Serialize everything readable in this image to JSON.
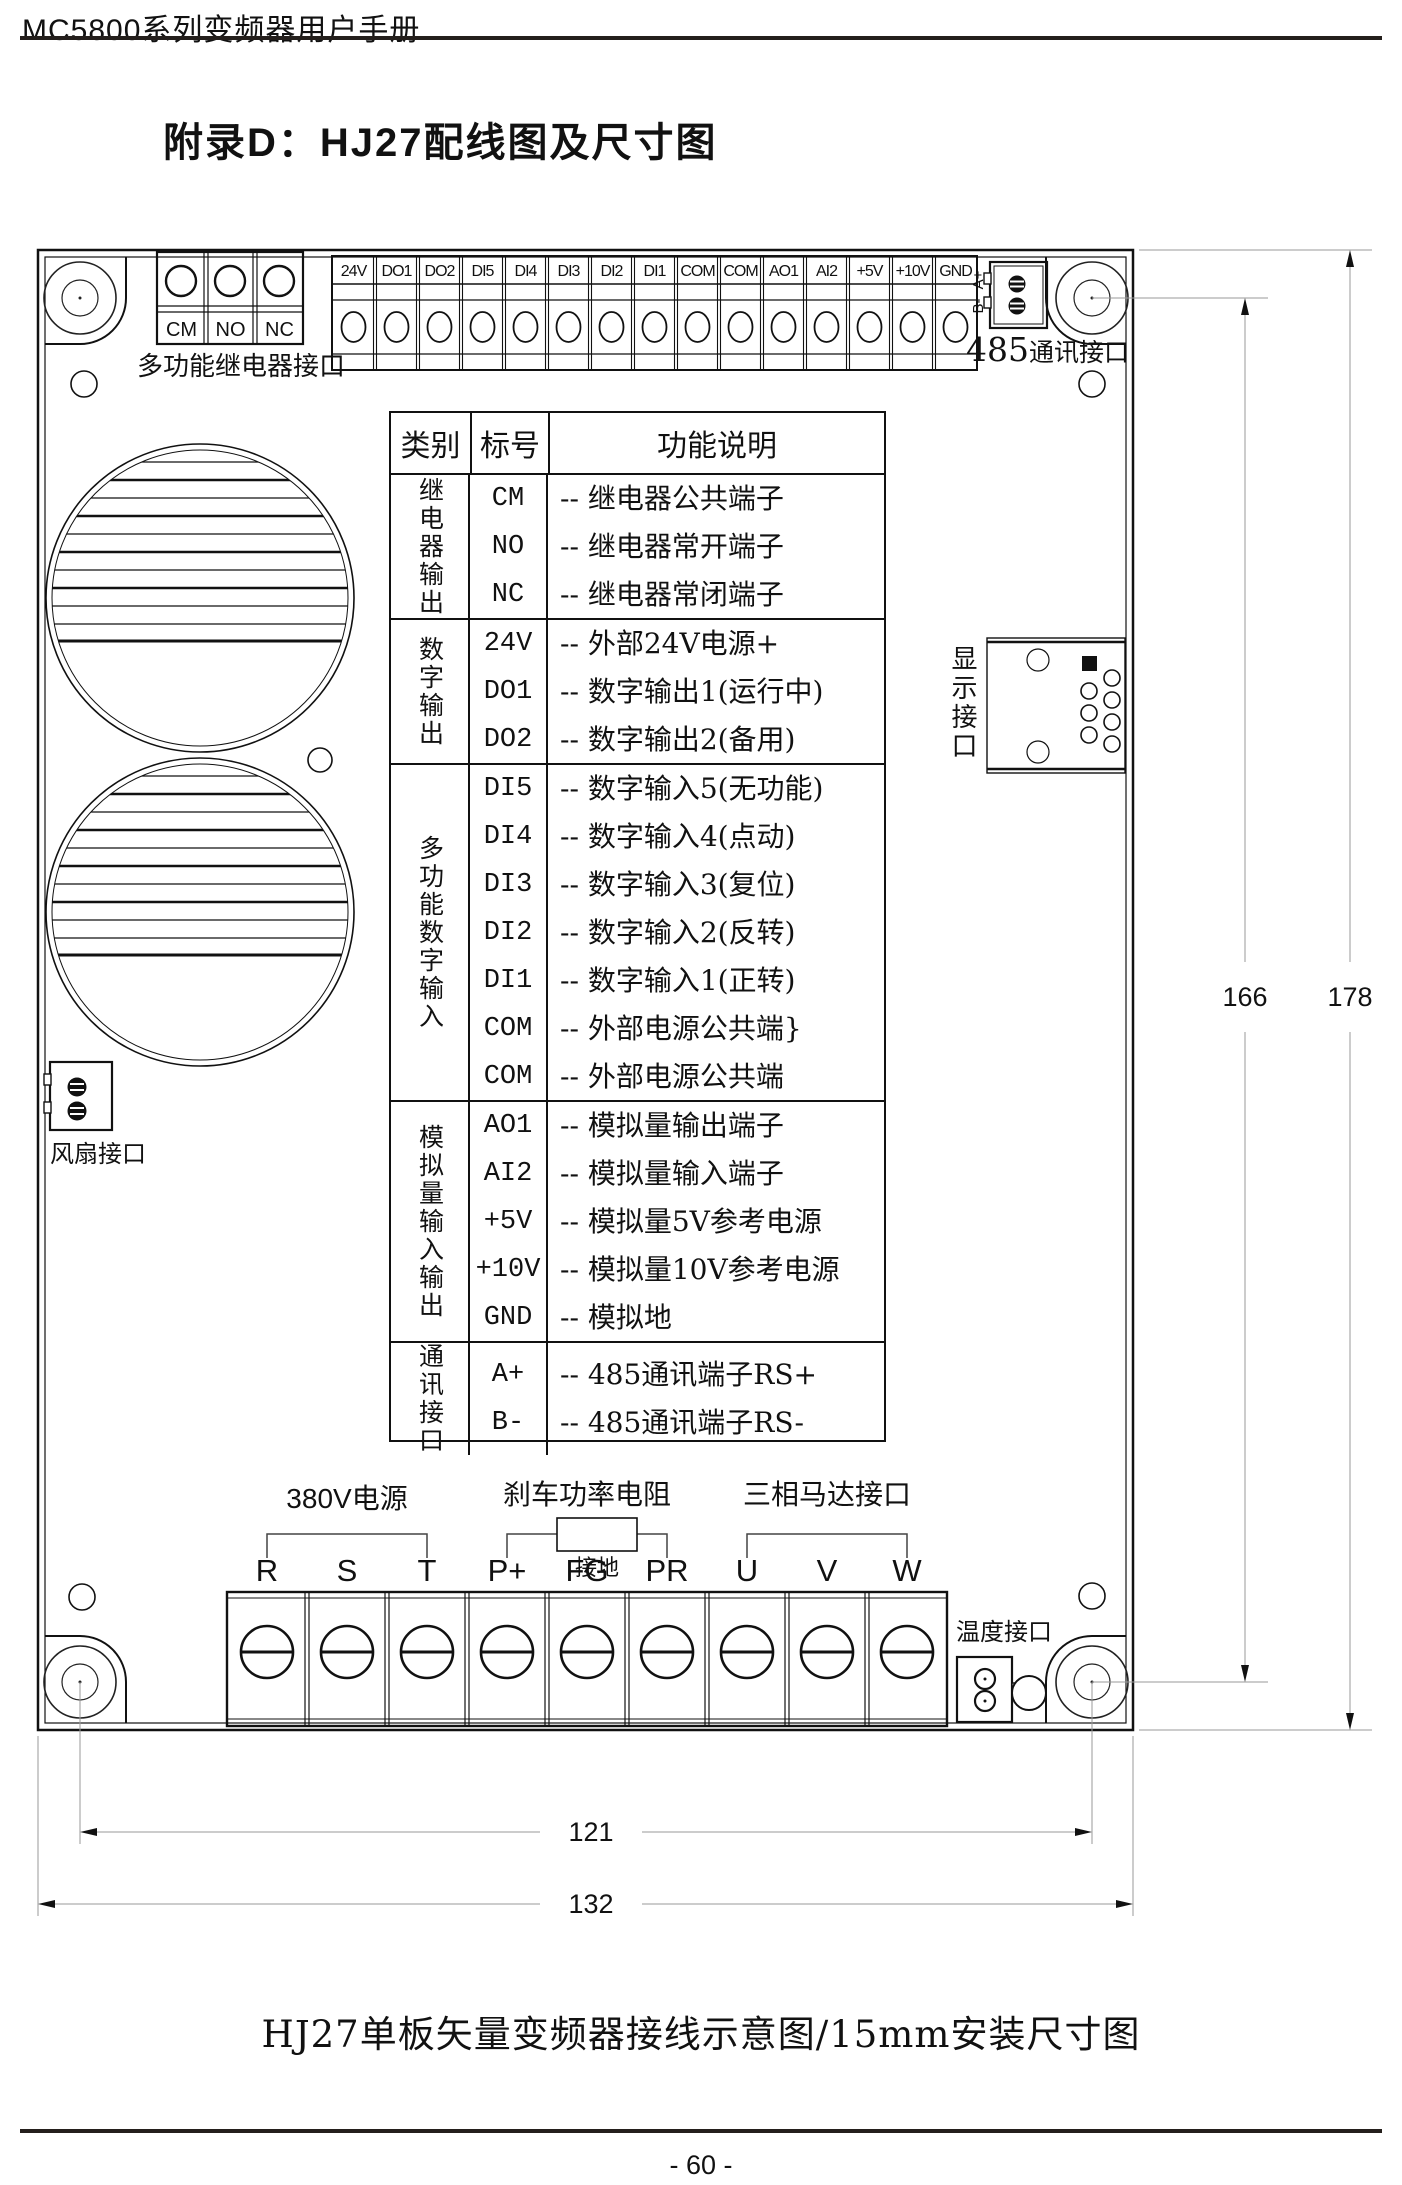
{
  "header": {
    "manual_title": "MC5800系列变频器用户手册"
  },
  "page_title": "附录D：HJ27配线图及尺寸图",
  "board": {
    "relay_port": {
      "terminals": [
        "CM",
        "NO",
        "NC"
      ],
      "caption": "多功能继电器接口"
    },
    "top_terminals": [
      "24V",
      "DO1",
      "DO2",
      "DI5",
      "DI4",
      "DI3",
      "DI2",
      "DI1",
      "COM",
      "COM",
      "AO1",
      "AI2",
      "+5V",
      "+10V",
      "GND"
    ],
    "rs485_port": {
      "pin_a": "A+",
      "pin_b": "B-",
      "number": "485",
      "label": "通讯接口"
    },
    "display_port": {
      "label": "显示接口"
    },
    "fan_port": {
      "label": "风扇接口"
    },
    "temp_port": {
      "label": "温度接口"
    },
    "bottom_terminals": [
      "R",
      "S",
      "T",
      "P+",
      "FG",
      "PR",
      "U",
      "V",
      "W"
    ],
    "bottom_groups": {
      "power": "380V电源",
      "brake": "刹车功率电阻",
      "motor": "三相马达接口",
      "ground": "接地"
    }
  },
  "dimensions": {
    "hole_height": "166",
    "board_height": "178",
    "hole_width": "121",
    "board_width": "132"
  },
  "table": {
    "headers": [
      "类别",
      "标号",
      "功能说明"
    ],
    "groups": [
      {
        "category": "继电器输出",
        "rows": [
          {
            "label": "CM",
            "desc": "-- 继电器公共端子"
          },
          {
            "label": "NO",
            "desc": "-- 继电器常开端子"
          },
          {
            "label": "NC",
            "desc": "-- 继电器常闭端子"
          }
        ]
      },
      {
        "category": "数字输出",
        "rows": [
          {
            "label": "24V",
            "desc": "-- 外部24V电源+"
          },
          {
            "label": "DO1",
            "desc": "-- 数字输出1(运行中)"
          },
          {
            "label": "DO2",
            "desc": "-- 数字输出2(备用)"
          }
        ]
      },
      {
        "category": "多功能数字输入",
        "rows": [
          {
            "label": "DI5",
            "desc": "-- 数字输入5(无功能)"
          },
          {
            "label": "DI4",
            "desc": "-- 数字输入4(点动)"
          },
          {
            "label": "DI3",
            "desc": "-- 数字输入3(复位)"
          },
          {
            "label": "DI2",
            "desc": "-- 数字输入2(反转)"
          },
          {
            "label": "DI1",
            "desc": "-- 数字输入1(正转)"
          },
          {
            "label": "COM",
            "desc": "-- 外部电源公共端}"
          },
          {
            "label": "COM",
            "desc": "-- 外部电源公共端"
          }
        ]
      },
      {
        "category": "模拟量输入输出",
        "rows": [
          {
            "label": "AO1",
            "desc": "-- 模拟量输出端子"
          },
          {
            "label": "AI2",
            "desc": "-- 模拟量输入端子"
          },
          {
            "label": "+5V",
            "desc": "-- 模拟量5V参考电源"
          },
          {
            "label": "+10V",
            "desc": "-- 模拟量10V参考电源"
          },
          {
            "label": "GND",
            "desc": "-- 模拟地"
          }
        ]
      },
      {
        "category": "通讯接口",
        "rows": [
          {
            "label": "A+",
            "desc": "-- 485通讯端子RS+"
          },
          {
            "label": "B-",
            "desc": "-- 485通讯端子RS-"
          }
        ]
      }
    ]
  },
  "caption": "HJ27单板矢量变频器接线示意图/15mm安装尺寸图",
  "footer": {
    "page_number": "- 60 -"
  }
}
